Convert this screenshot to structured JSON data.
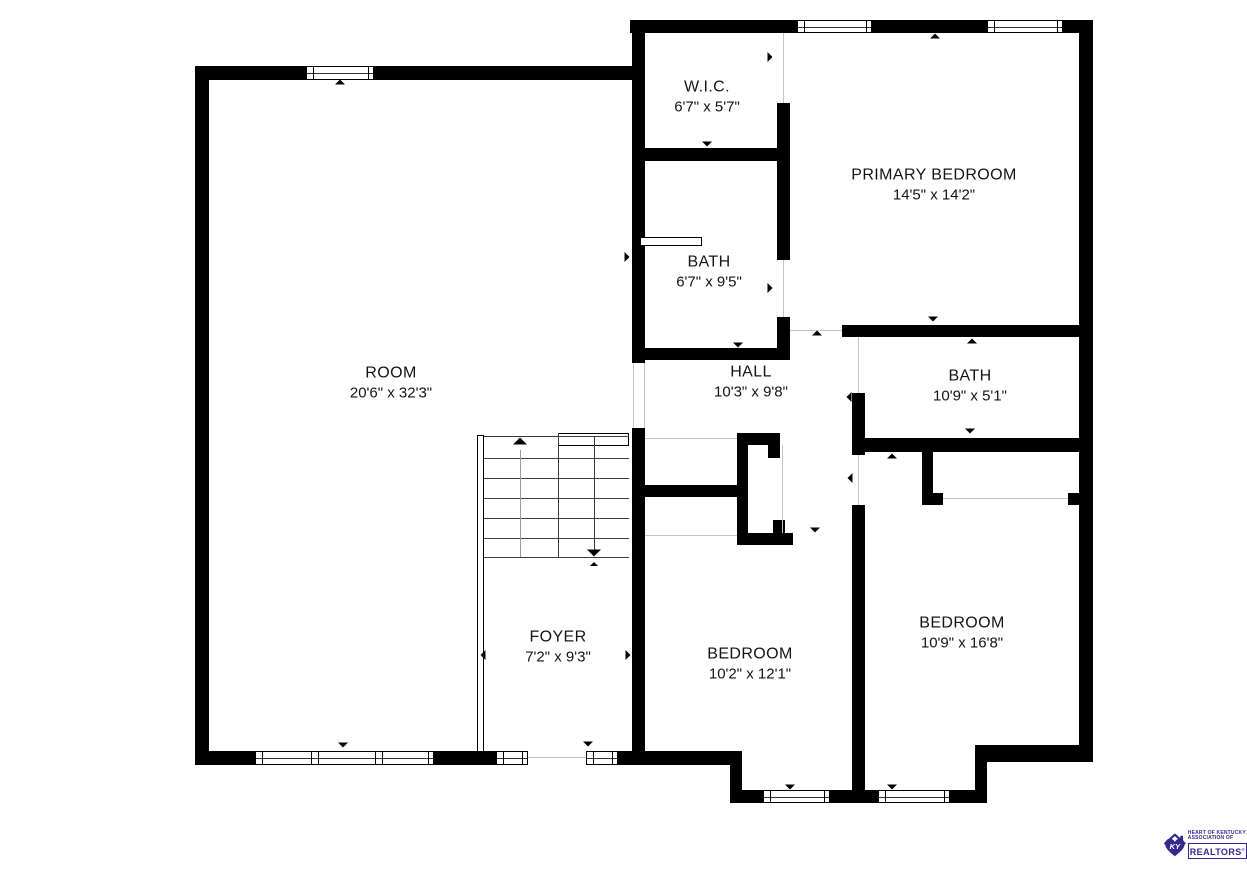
{
  "plan": {
    "colors": {
      "wall": "#000000",
      "floor_line": "#c4c4c4",
      "label": "#141414",
      "stair_line": "#3a3a3a",
      "stair_stem": "#9a9a9a",
      "logo": "#34298F"
    },
    "rooms": [
      {
        "name": "ROOM",
        "dims": "20'6\" x 32'3\"",
        "cx": 391,
        "cy": 383
      },
      {
        "name": "W.I.C.",
        "dims": "6'7\" x 5'7\"",
        "cx": 707,
        "cy": 97
      },
      {
        "name": "PRIMARY BEDROOM",
        "dims": "14'5\" x 14'2\"",
        "cx": 934,
        "cy": 185
      },
      {
        "name": "BATH",
        "dims": "6'7\" x 9'5\"",
        "cx": 709,
        "cy": 272
      },
      {
        "name": "HALL",
        "dims": "10'3\" x 9'8\"",
        "cx": 751,
        "cy": 382
      },
      {
        "name": "BATH",
        "dims": "10'9\" x 5'1\"",
        "cx": 970,
        "cy": 386
      },
      {
        "name": "FOYER",
        "dims": "7'2\" x 9'3\"",
        "cx": 558,
        "cy": 647
      },
      {
        "name": "BEDROOM",
        "dims": "10'2\" x 12'1\"",
        "cx": 750,
        "cy": 664
      },
      {
        "name": "BEDROOM",
        "dims": "10'9\" x 16'8\"",
        "cx": 962,
        "cy": 633
      }
    ],
    "walls": [
      [
        195,
        66,
        449,
        14
      ],
      [
        195,
        66,
        14,
        699
      ],
      [
        195,
        751,
        547,
        14
      ],
      [
        630,
        20,
        463,
        13
      ],
      [
        1079,
        20,
        14,
        742
      ],
      [
        975,
        745,
        118,
        17
      ],
      [
        975,
        745,
        12,
        58
      ],
      [
        730,
        790,
        257,
        13
      ],
      [
        730,
        751,
        12,
        52
      ],
      [
        632,
        20,
        13,
        343
      ],
      [
        632,
        428,
        13,
        337
      ],
      [
        632,
        148,
        158,
        13
      ],
      [
        777,
        103,
        13,
        157
      ],
      [
        777,
        317,
        13,
        43
      ],
      [
        632,
        348,
        158,
        12
      ],
      [
        842,
        325,
        251,
        12
      ],
      [
        852,
        393,
        13,
        62
      ],
      [
        852,
        505,
        13,
        298
      ],
      [
        852,
        438,
        241,
        14
      ],
      [
        922,
        450,
        11,
        55
      ],
      [
        922,
        493,
        21,
        12
      ],
      [
        1068,
        493,
        25,
        12
      ],
      [
        737,
        433,
        11,
        112
      ],
      [
        737,
        433,
        43,
        12
      ],
      [
        768,
        445,
        12,
        13
      ],
      [
        632,
        485,
        116,
        12
      ],
      [
        737,
        533,
        56,
        12
      ],
      [
        773,
        520,
        12,
        13
      ]
    ],
    "thin_rects": [
      [
        477,
        435,
        7,
        317
      ],
      [
        558,
        433,
        71,
        13
      ],
      [
        640,
        237,
        62,
        9
      ]
    ],
    "floor_lines": [
      [
        528,
        757,
        60,
        1
      ],
      [
        790,
        330,
        52,
        1
      ],
      [
        858,
        337,
        1,
        56
      ],
      [
        858,
        455,
        1,
        50
      ],
      [
        783,
        33,
        1,
        70
      ],
      [
        783,
        260,
        1,
        57
      ],
      [
        782,
        445,
        1,
        88
      ],
      [
        943,
        498,
        125,
        1
      ],
      [
        645,
        438,
        92,
        1
      ],
      [
        645,
        535,
        92,
        1
      ],
      [
        633,
        363,
        1,
        65
      ],
      [
        644,
        363,
        1,
        65
      ]
    ],
    "door_gaps": [
      [
        526,
        751,
        62,
        14
      ]
    ],
    "windows": [
      [
        306,
        66,
        68,
        14,
        []
      ],
      [
        797,
        20,
        75,
        13,
        []
      ],
      [
        987,
        20,
        76,
        13,
        []
      ],
      [
        255,
        751,
        179,
        14,
        [
          55,
          62,
          119,
          126
        ]
      ],
      [
        496,
        751,
        32,
        14,
        []
      ],
      [
        586,
        751,
        32,
        14,
        []
      ],
      [
        763,
        790,
        67,
        13,
        []
      ],
      [
        878,
        790,
        72,
        13,
        []
      ]
    ],
    "stairs": {
      "x": 484,
      "w": 145,
      "divider_x": 558,
      "divider_y1": 433,
      "divider_y2": 557,
      "tread_ys": [
        436,
        458,
        478,
        498,
        518,
        538,
        557
      ],
      "up_arrow": {
        "x": 520,
        "y1": 450,
        "y2": 557,
        "head_y": 441
      },
      "down_arrow": {
        "x": 594,
        "y1": 436,
        "y2": 550,
        "head_y": 553,
        "tick_y": 564
      }
    },
    "markers": [
      [
        "up",
        340,
        82
      ],
      [
        "up",
        935,
        36
      ],
      [
        "down",
        933,
        319
      ],
      [
        "up",
        972,
        341
      ],
      [
        "down",
        970,
        431
      ],
      [
        "up",
        892,
        456
      ],
      [
        "right",
        770,
        57
      ],
      [
        "left",
        641,
        56
      ],
      [
        "right",
        770,
        288
      ],
      [
        "up",
        817,
        333
      ],
      [
        "up",
        855,
        334
      ],
      [
        "left",
        849,
        397
      ],
      [
        "left",
        850,
        478
      ],
      [
        "down",
        588,
        744
      ],
      [
        "down",
        343,
        745
      ],
      [
        "down",
        790,
        787
      ],
      [
        "down",
        892,
        787
      ],
      [
        "left",
        205,
        257
      ],
      [
        "right",
        627,
        257
      ],
      [
        "right",
        1084,
        180
      ],
      [
        "left",
        787,
        180
      ],
      [
        "right",
        1084,
        378
      ],
      [
        "right",
        1084,
        622
      ],
      [
        "left",
        857,
        622
      ],
      [
        "left",
        483,
        655
      ],
      [
        "right",
        628,
        655
      ],
      [
        "down",
        815,
        530
      ],
      [
        "down",
        738,
        345
      ],
      [
        "down",
        707,
        144
      ]
    ],
    "logo": {
      "monogram": "KY",
      "line1": "HEART OF KENTUCKY",
      "line2": "ASSOCIATION OF",
      "name": "REALTORS",
      "registered": "®"
    }
  }
}
